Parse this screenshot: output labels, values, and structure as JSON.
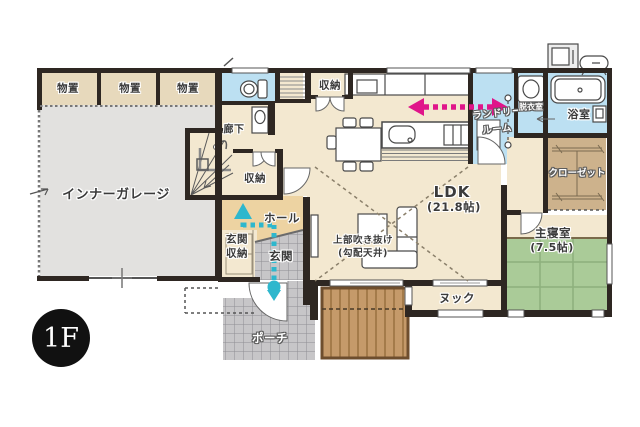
{
  "floor_badge": "1F",
  "colors": {
    "wall": "#2E2722",
    "floor_cream": "#F3E8D0",
    "hall_tan": "#EDD3A2",
    "storage_tan": "#E7D9BC",
    "garage_gray": "#E2E1DF",
    "wet_room_blue": "#BCE0F2",
    "tatami_green": "#AACB98",
    "closet_brown": "#CDB28C",
    "deck_brown": "#C59A6A",
    "tile_gray": "#C7C6C8",
    "arrow_pink": "#E0158A",
    "arrow_teal": "#2EB7CD"
  },
  "rooms": {
    "storage_a": {
      "label": "物置"
    },
    "storage_b": {
      "label": "物置"
    },
    "storage_c": {
      "label": "物置"
    },
    "garage": {
      "label": "インナーガレージ"
    },
    "corridor": {
      "label": "廊下"
    },
    "stair_storage": {
      "label": "収納"
    },
    "ldk_storage": {
      "label": "収納"
    },
    "entrance_storage": {
      "label_line1": "玄関",
      "label_line2": "収納"
    },
    "hall": {
      "label": "ホール"
    },
    "entrance": {
      "label": "玄関"
    },
    "porch": {
      "label": "ポーチ"
    },
    "ldk": {
      "label": "LDK",
      "size": "(21.8帖)"
    },
    "void_above": {
      "label": "上部吹き抜け",
      "sub": "(勾配天井)"
    },
    "laundry": {
      "label_line1": "ランドリー",
      "label_line2": "ルーム"
    },
    "dressing": {
      "label": "脱衣室"
    },
    "bath": {
      "label": "浴室"
    },
    "closet": {
      "label": "クローゼット"
    },
    "bedroom": {
      "label": "主寝室",
      "size": "(7.5帖)"
    },
    "nook": {
      "label": "ヌック"
    }
  },
  "icons": [
    "toilet-icon",
    "washbasin-icon",
    "washing-machine-icon",
    "bathtub-icon",
    "bath-washstand-icon",
    "kitchen-sink-icon",
    "stove-icon",
    "dining-table-icon",
    "sofa-icon",
    "living-table-icon",
    "tv-icon",
    "stairs-icon",
    "heat-pump-icon",
    "water-heater-tank-icon",
    "laundry-pole-icon",
    "laundry-flow-arrow-icon",
    "entrance-flow-arrow-icon",
    "garage-shutter-icon"
  ]
}
